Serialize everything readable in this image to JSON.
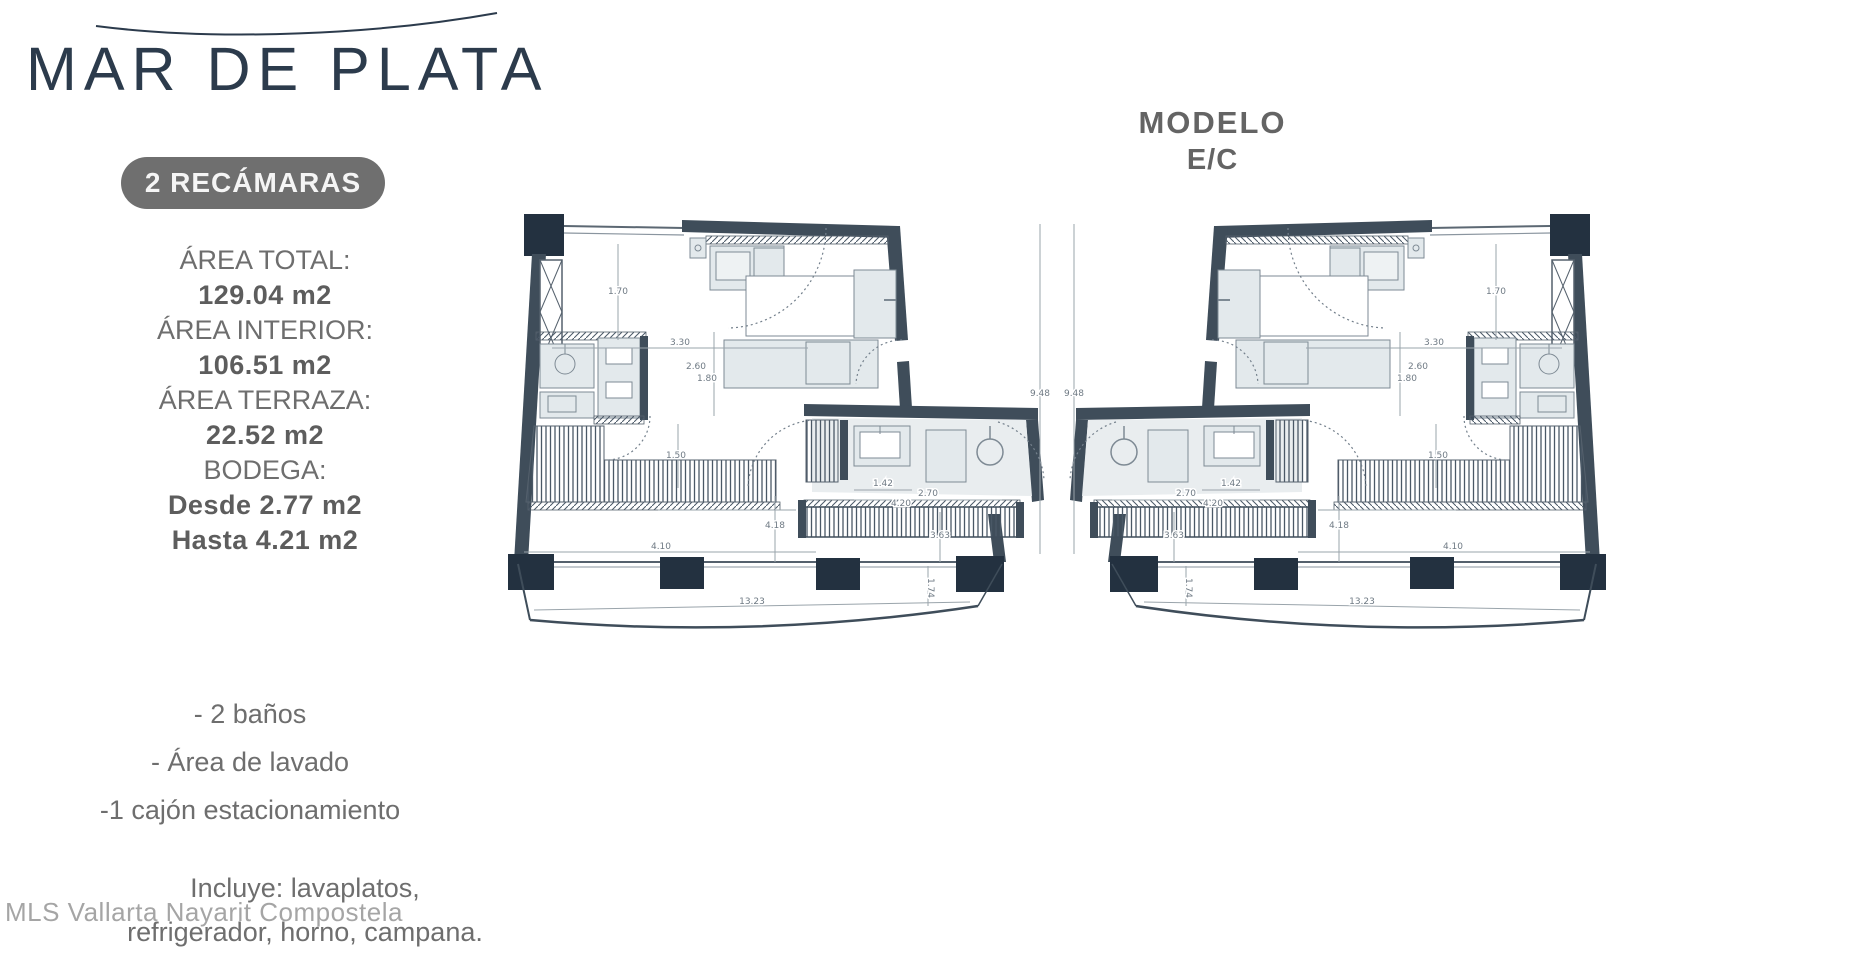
{
  "brand": {
    "title": "MAR DE PLATA"
  },
  "badge": {
    "label": "2 RECÁMARAS"
  },
  "specs": [
    {
      "label": "ÁREA TOTAL:",
      "value": "129.04 m2"
    },
    {
      "label": "ÁREA INTERIOR:",
      "value": "106.51 m2"
    },
    {
      "label": "ÁREA TERRAZA:",
      "value": "22.52 m2"
    },
    {
      "label": "BODEGA:",
      "value": "Desde 2.77 m2",
      "value2": "Hasta 4.21 m2"
    }
  ],
  "features": [
    "- 2 baños",
    "- Área de lavado",
    "-1  cajón estacionamiento"
  ],
  "includes": [
    "Incluye: lavaplatos,",
    "refrigerador, horno, campana."
  ],
  "watermark": "MLS Vallarta Nayarit Compostela",
  "model": {
    "label": "MODELO",
    "code": "E/C"
  },
  "floor_plans": {
    "units": 2,
    "layout": "two mirrored two-bedroom unit plans with terrace columns",
    "dimension_labels": [
      {
        "t": "1.70",
        "x": 110,
        "y": 82
      },
      {
        "t": "3.30",
        "x": 172,
        "y": 133
      },
      {
        "t": "2.60",
        "x": 188,
        "y": 157
      },
      {
        "t": "1.80",
        "x": 199,
        "y": 169
      },
      {
        "t": "1.50",
        "x": 168,
        "y": 246
      },
      {
        "t": "1.42",
        "x": 375,
        "y": 274
      },
      {
        "t": "2.70",
        "x": 420,
        "y": 284
      },
      {
        "t": "9.48",
        "x": 532,
        "y": 184
      },
      {
        "t": "4.20",
        "x": 393,
        "y": 294
      },
      {
        "t": "4.18",
        "x": 267,
        "y": 316
      },
      {
        "t": "4.10",
        "x": 153,
        "y": 337
      },
      {
        "t": "3.63",
        "x": 432,
        "y": 326
      },
      {
        "t": "1.74",
        "x": 420,
        "y": 376,
        "rot": 90
      },
      {
        "t": "13.23",
        "x": 244,
        "y": 392
      }
    ],
    "colors": {
      "wall": "#3f4d5a",
      "column": "#233140",
      "furniture": "#e3e9ec",
      "hatch": "#52606d",
      "dimension": "#8d97a0",
      "title_navy": "#2c3b4c",
      "text_gray": "#6e6e6e",
      "badge_bg": "#6f6f6f"
    }
  }
}
